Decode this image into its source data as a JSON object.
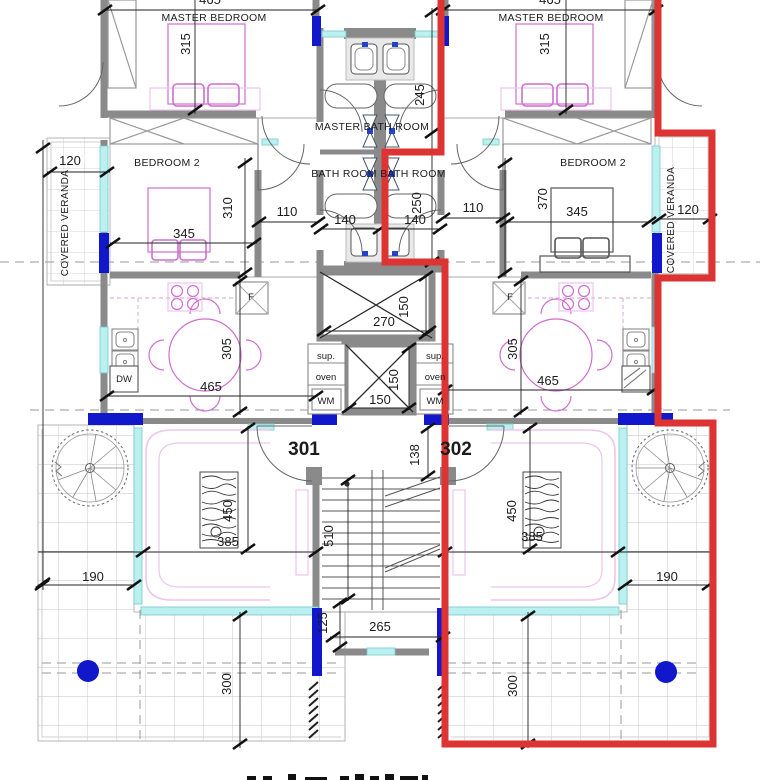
{
  "plan": {
    "units": {
      "left": "301",
      "right": "302"
    },
    "rooms": {
      "master_bedroom": "MASTER BEDROOM",
      "bedroom2": "BEDROOM 2",
      "master_bathroom": "MASTER BATH ROOM",
      "bathroom": "BATH ROOM",
      "covered_veranda": "COVERED VERANDA"
    },
    "appliances": {
      "fridge": "F",
      "dishwasher": "DW",
      "cupboard": "sup.",
      "oven": "oven",
      "washing_machine": "WM"
    },
    "dims": {
      "d465": "465",
      "d315": "315",
      "d245": "245",
      "d250": "250",
      "d140": "140",
      "d110": "110",
      "d120": "120",
      "d345": "345",
      "d310": "310",
      "d370": "370",
      "d305": "305",
      "d270": "270",
      "d150": "150",
      "d138": "138",
      "d510": "510",
      "d125": "125",
      "d265": "265",
      "d450": "450",
      "d385": "385",
      "d190": "190",
      "d300": "300"
    },
    "colors": {
      "highlight_outline": "#de3333",
      "column": "#1118cc",
      "wall": "#8a8a8a",
      "window": "#baf0f0",
      "furniture": "#cf6fcf",
      "dim_text": "#1c1c1c"
    }
  }
}
